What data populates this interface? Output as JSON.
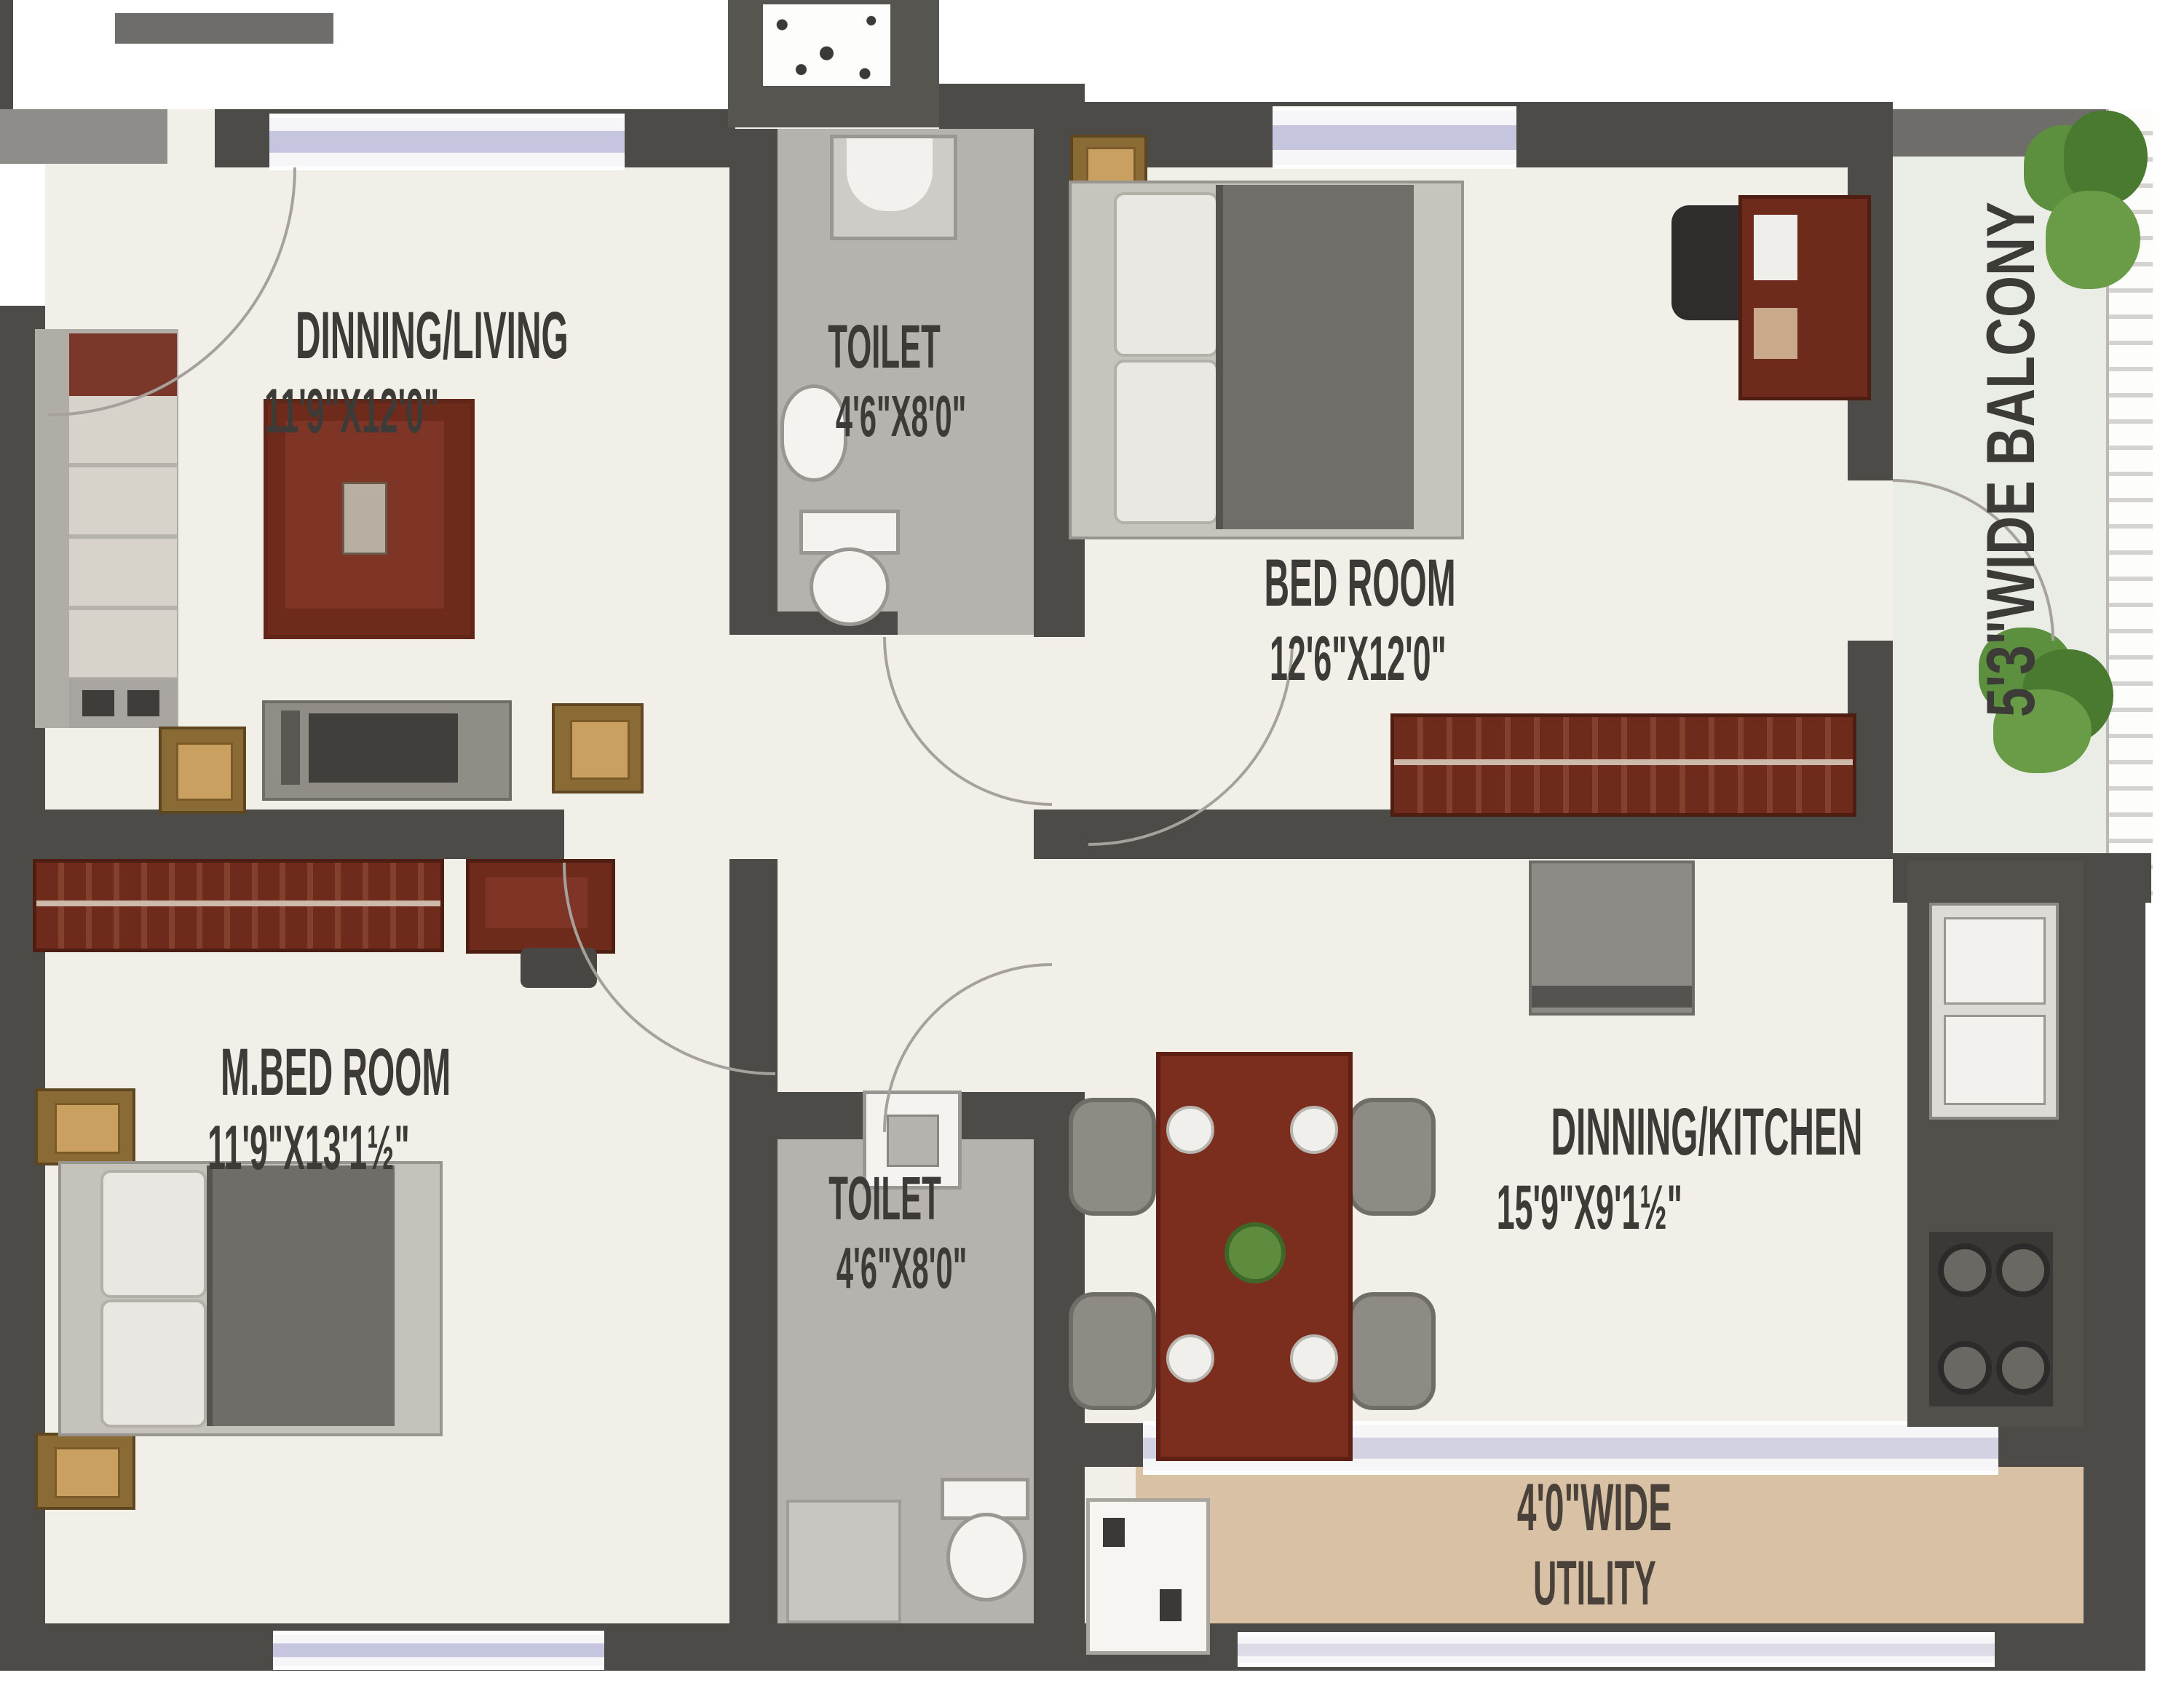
{
  "floor_plan": {
    "rooms": [
      {
        "name": "DINNING/LIVING",
        "dims": "11'9\"X12'0\""
      },
      {
        "name": "TOILET",
        "dims": "4'6\"X8'0\""
      },
      {
        "name": "BED ROOM",
        "dims": "12'6\"X12'0\""
      },
      {
        "name": "M.BED ROOM",
        "dims": "11'9\"X13'1½\""
      },
      {
        "name": "TOILET",
        "dims": "4'6\"X8'0\""
      },
      {
        "name": "DINNING/KITCHEN",
        "dims": "15'9\"X9'1½\""
      },
      {
        "name": "4'0\"WIDE",
        "dims": "UTILITY"
      },
      {
        "name": "5'3\"WIDE BALCONY",
        "dims": ""
      }
    ],
    "colors": {
      "wall": "#4c4b47",
      "floor": "#f2efe8",
      "toilet_floor": "#b6b3ae",
      "utility_floor": "#d8c1a4",
      "balcony_floor": "#eaece6",
      "window_glass": "#c6c5df",
      "furniture_wood": "#6e2b1c",
      "accent_gold": "#c9a05f",
      "plant_green": "#5c8f3e",
      "label_text": "#3c3b38"
    }
  }
}
